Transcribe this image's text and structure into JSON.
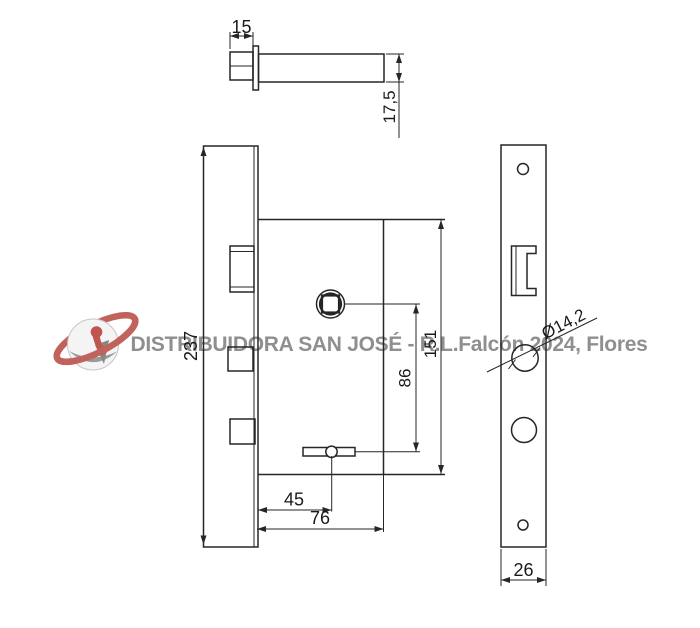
{
  "watermark": {
    "text": "DISTRIBUIDORA SAN JOSÉ - R.L.Falcón 2024, Flores",
    "text_color": "#8f8f8f",
    "logo_icon": "planet-keyhole-logo",
    "logo_ring_color": "#c2625d",
    "logo_keyhole_color": "#bf564f",
    "logo_sphere_color": "#f4f4f4",
    "logo_shadow_color": "#999999"
  },
  "drawing": {
    "background_color": "#ffffff",
    "line_color": "#262626",
    "views": {
      "bolt_side": {
        "dims": {
          "head_width": "15",
          "shaft_diameter": "17,5"
        }
      },
      "lock_body_side": {
        "dims": {
          "faceplate_height": "237",
          "case_height": "151",
          "spindle_to_cam": "86",
          "cam_offset": "45",
          "case_depth": "76"
        }
      },
      "faceplate_front": {
        "dims": {
          "plate_width": "26",
          "cylinder_hole_diameter": "Ø14,2"
        }
      }
    }
  }
}
